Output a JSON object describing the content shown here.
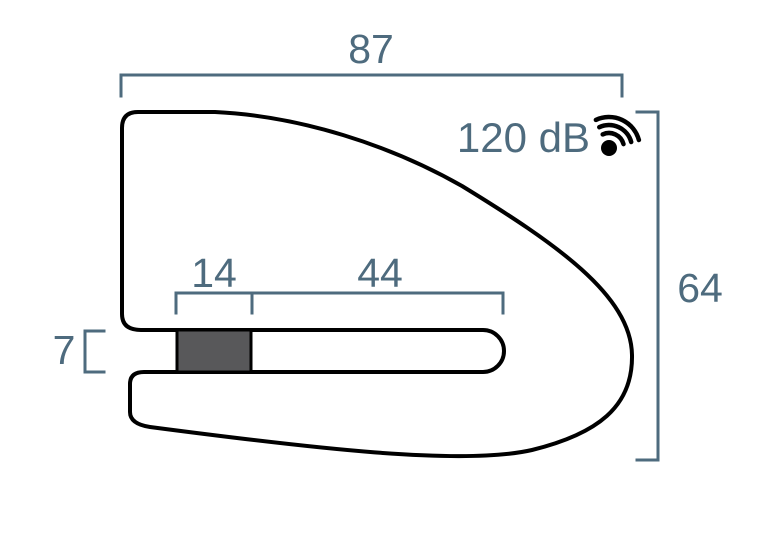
{
  "diagram": {
    "dimensions": {
      "overall_width": "87",
      "overall_height": "64",
      "pin_width": "14",
      "slot_length": "44",
      "jaw_gap": "7"
    },
    "alarm_label": "120 dB",
    "icons": {
      "sound_icon": "sound-waves-icon"
    },
    "colors": {
      "annotation": "#4e6b7e",
      "outline": "#000000",
      "pin_fill": "#58585a",
      "background": "#ffffff"
    }
  }
}
